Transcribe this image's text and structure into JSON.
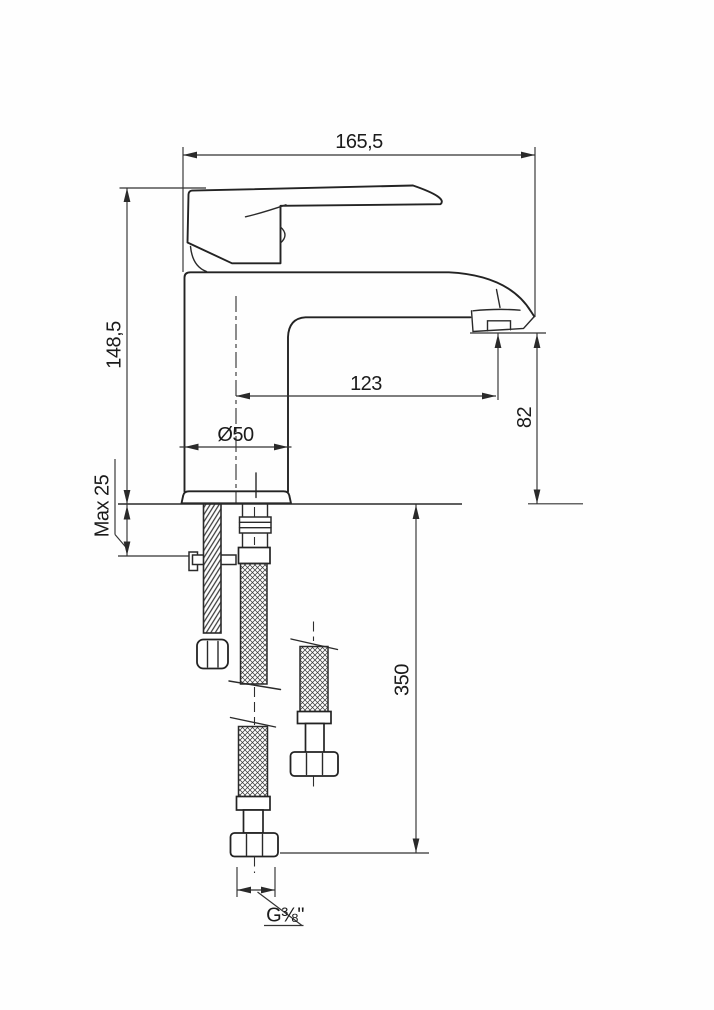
{
  "page": {
    "background": "#fefefe",
    "line_color": "#232323",
    "kind": "technical dimension drawing, single-lever basin mixer tap with flexible supply hoses"
  },
  "drawing": {
    "labels": {
      "overall_width": "165,5",
      "overall_height": "148,5",
      "max_deck_thickness": "Max 25",
      "base_diameter": "Ø50",
      "spout_reach": "123",
      "outlet_height": "82",
      "hose_length": "350",
      "connection_thread": "G⅜\""
    }
  }
}
